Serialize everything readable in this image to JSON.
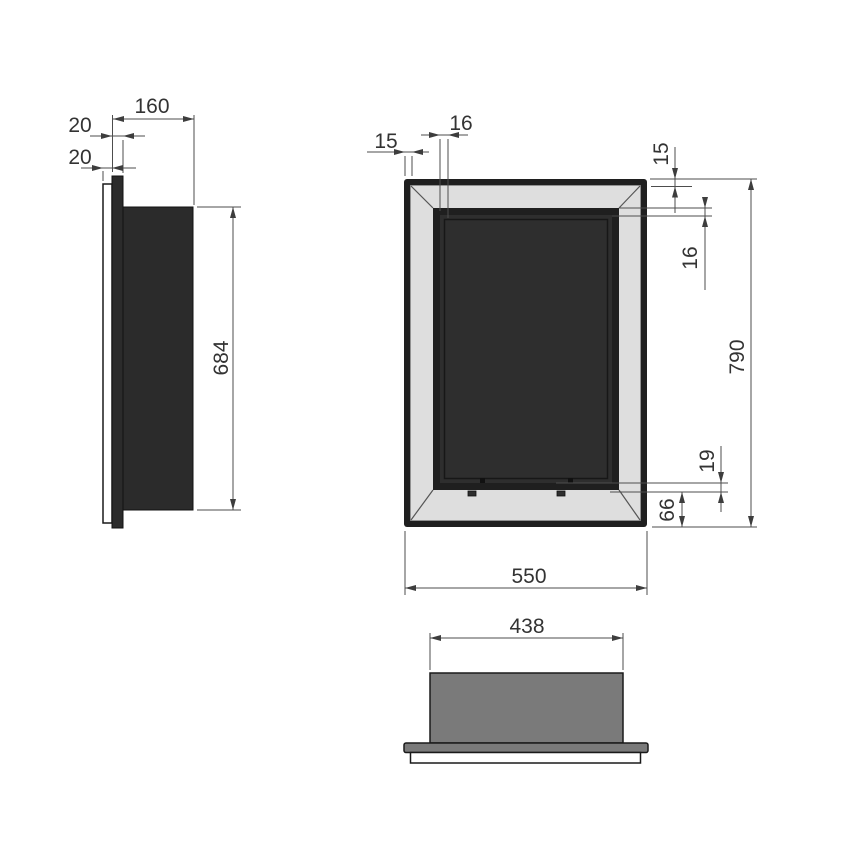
{
  "drawing": {
    "type": "technical-drawing",
    "views": [
      "side-view",
      "front-view",
      "top-view"
    ],
    "side": {
      "depth": "160",
      "flange": "20",
      "plate": "20",
      "height": "684"
    },
    "front": {
      "frame_left": "15",
      "inner_top": "16",
      "frame_top": "15",
      "inner_right": "16",
      "height": "790",
      "lip": "19",
      "bevel": "66",
      "width": "550"
    },
    "top": {
      "width": "438"
    },
    "colors": {
      "body_fill": "#2b2b2b",
      "interior_fill": "#2e2e2e",
      "bevel_fill": "#dedede",
      "frame_fill": "#1f1f1f",
      "top_body_fill": "#7a7a7a",
      "dimension_line": "#4d4d4d",
      "text": "#333333",
      "background": "#ffffff"
    }
  }
}
